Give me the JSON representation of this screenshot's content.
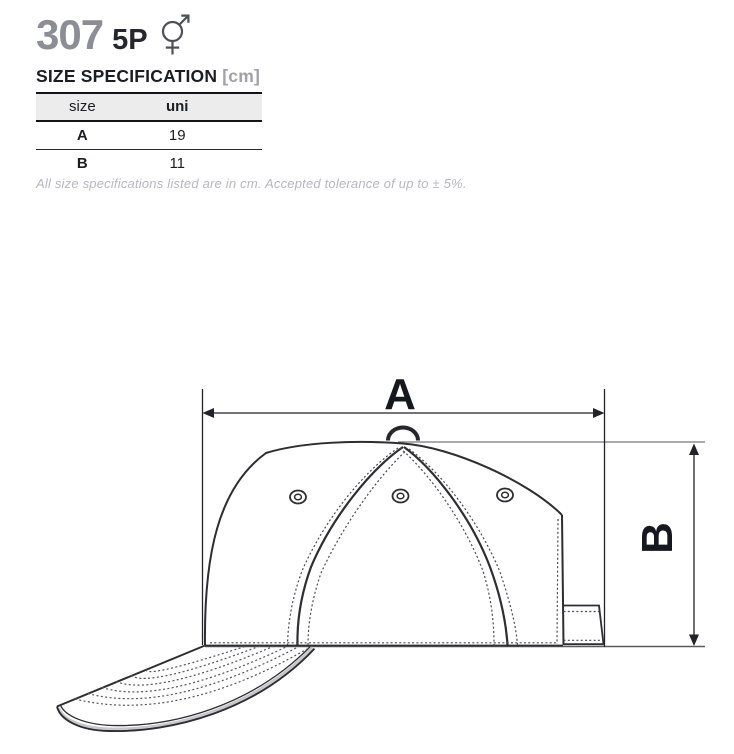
{
  "header": {
    "product_number": "307",
    "product_code": "5P",
    "gender_icon": "male-female-sign"
  },
  "spec": {
    "title": "SIZE SPECIFICATION",
    "unit_suffix": "[cm]",
    "table": {
      "columns": [
        "size",
        "uni"
      ],
      "rows": [
        {
          "size": "A",
          "uni": "19"
        },
        {
          "size": "B",
          "uni": "11"
        }
      ]
    },
    "note": "All size specifications listed are in cm. Accepted tolerance of up to ± 5%."
  },
  "diagram": {
    "label_a": "A",
    "label_b": "B",
    "subject": "5-panel cap side view with dimension arrows"
  },
  "colors": {
    "product_number_gray": "#8d8d95",
    "heading_dark": "#1c1c24",
    "muted_gray": "#a0a0a8",
    "note_gray": "#b6b6be",
    "table_header_bg": "#ececec",
    "drawing_line": "#2d2d32"
  }
}
